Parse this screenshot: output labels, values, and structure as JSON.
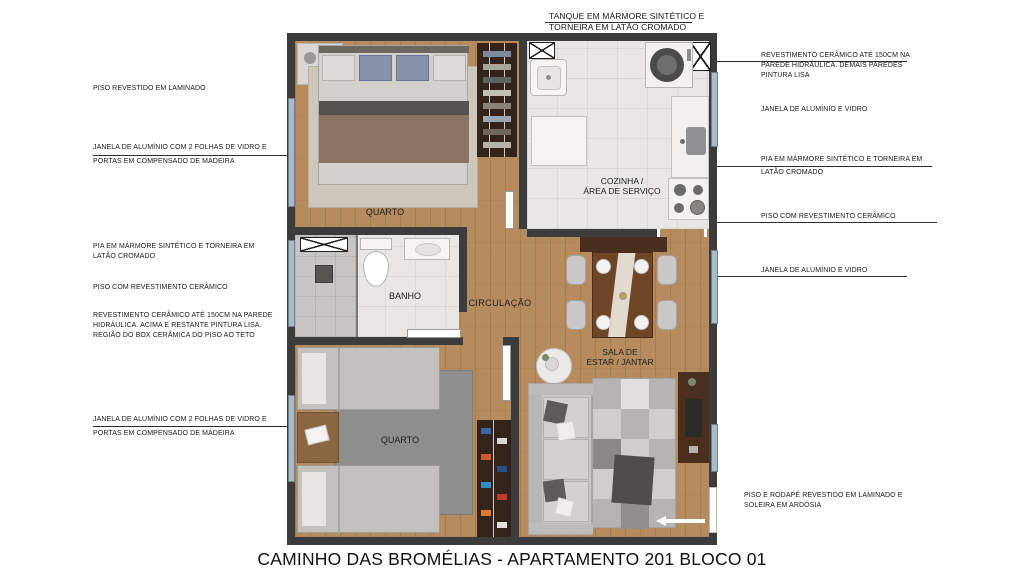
{
  "title": "CAMINHO DAS BROMÉLIAS - APARTAMENTO 201 BLOCO 01",
  "rooms": {
    "bedroom1_label": "QUARTO",
    "kitchen_label_line1": "COZINHA /",
    "kitchen_label_line2": "ÁREA DE SERVIÇO",
    "bath_label": "BANHO",
    "circulation_label": "CIRCULAÇÃO",
    "living_label_line1": "SALA DE",
    "living_label_line2": "ESTAR / JANTAR",
    "bedroom2_label": "QUARTO"
  },
  "annotations": {
    "top": {
      "line1": "TANQUE EM MÁRMORE SINTÉTICO E",
      "line2": "TORNEIRA EM LATÃO CROMADO"
    },
    "left": [
      {
        "line1": "PISO REVESTIDO EM LAMINADO"
      },
      {
        "line1": "JANELA DE ALUMÍNIO COM 2 FOLHAS DE VIDRO E",
        "line2": "PORTAS EM COMPENSADO DE MADEIRA"
      },
      {
        "line1": "PIA EM MÁRMORE SINTÉTICO E TORNEIRA EM",
        "line2": "LATÃO CROMADO"
      },
      {
        "line1": "PISO COM REVESTIMENTO CERÂMICO"
      },
      {
        "line1": "REVESTIMENTO CERÂMICO ATÉ 150CM NA PAREDE",
        "line2": "HIDRÁULICA. ACIMA E RESTANTE PINTURA LISA.",
        "line3": "REGIÃO DO BOX CERÂMICA DO PISO AO TETO"
      },
      {
        "line1": "JANELA DE ALUMÍNIO COM 2 FOLHAS DE VIDRO E",
        "line2": "PORTAS EM COMPENSADO DE MADEIRA"
      }
    ],
    "right": [
      {
        "line1": "REVESTIMENTO CERÂMICO ATÉ 150CM NA",
        "line2": "PAREDE HIDRÁULICA. DEMAIS PAREDES",
        "line3": "PINTURA LISA"
      },
      {
        "line1": "JANELA DE ALUMÍNIO E VIDRO"
      },
      {
        "line1": "PIA EM MÁRMORE SINTÉTICO E TORNEIRA EM",
        "line2": "LATÃO CROMADO"
      },
      {
        "line1": "PISO COM REVESTIMENTO CERÂMICO"
      },
      {
        "line1": "JANELA DE ALUMÍNIO E VIDRO"
      },
      {
        "line1": "PISO E RODAPÉ REVESTIDO EM LAMINADO E",
        "line2": "SOLEIRA EM ARDÓSIA"
      }
    ]
  },
  "colors": {
    "wall": "#3c3c3c",
    "wood_floor": "#b68c5f",
    "ceramic_floor": "#e8e7e5",
    "window_glass": "#a9bbc9",
    "annotation_text": "#1a1a1a",
    "furniture_dark_wood": "#33231a",
    "sofa_gray": "#c8c7c5"
  }
}
